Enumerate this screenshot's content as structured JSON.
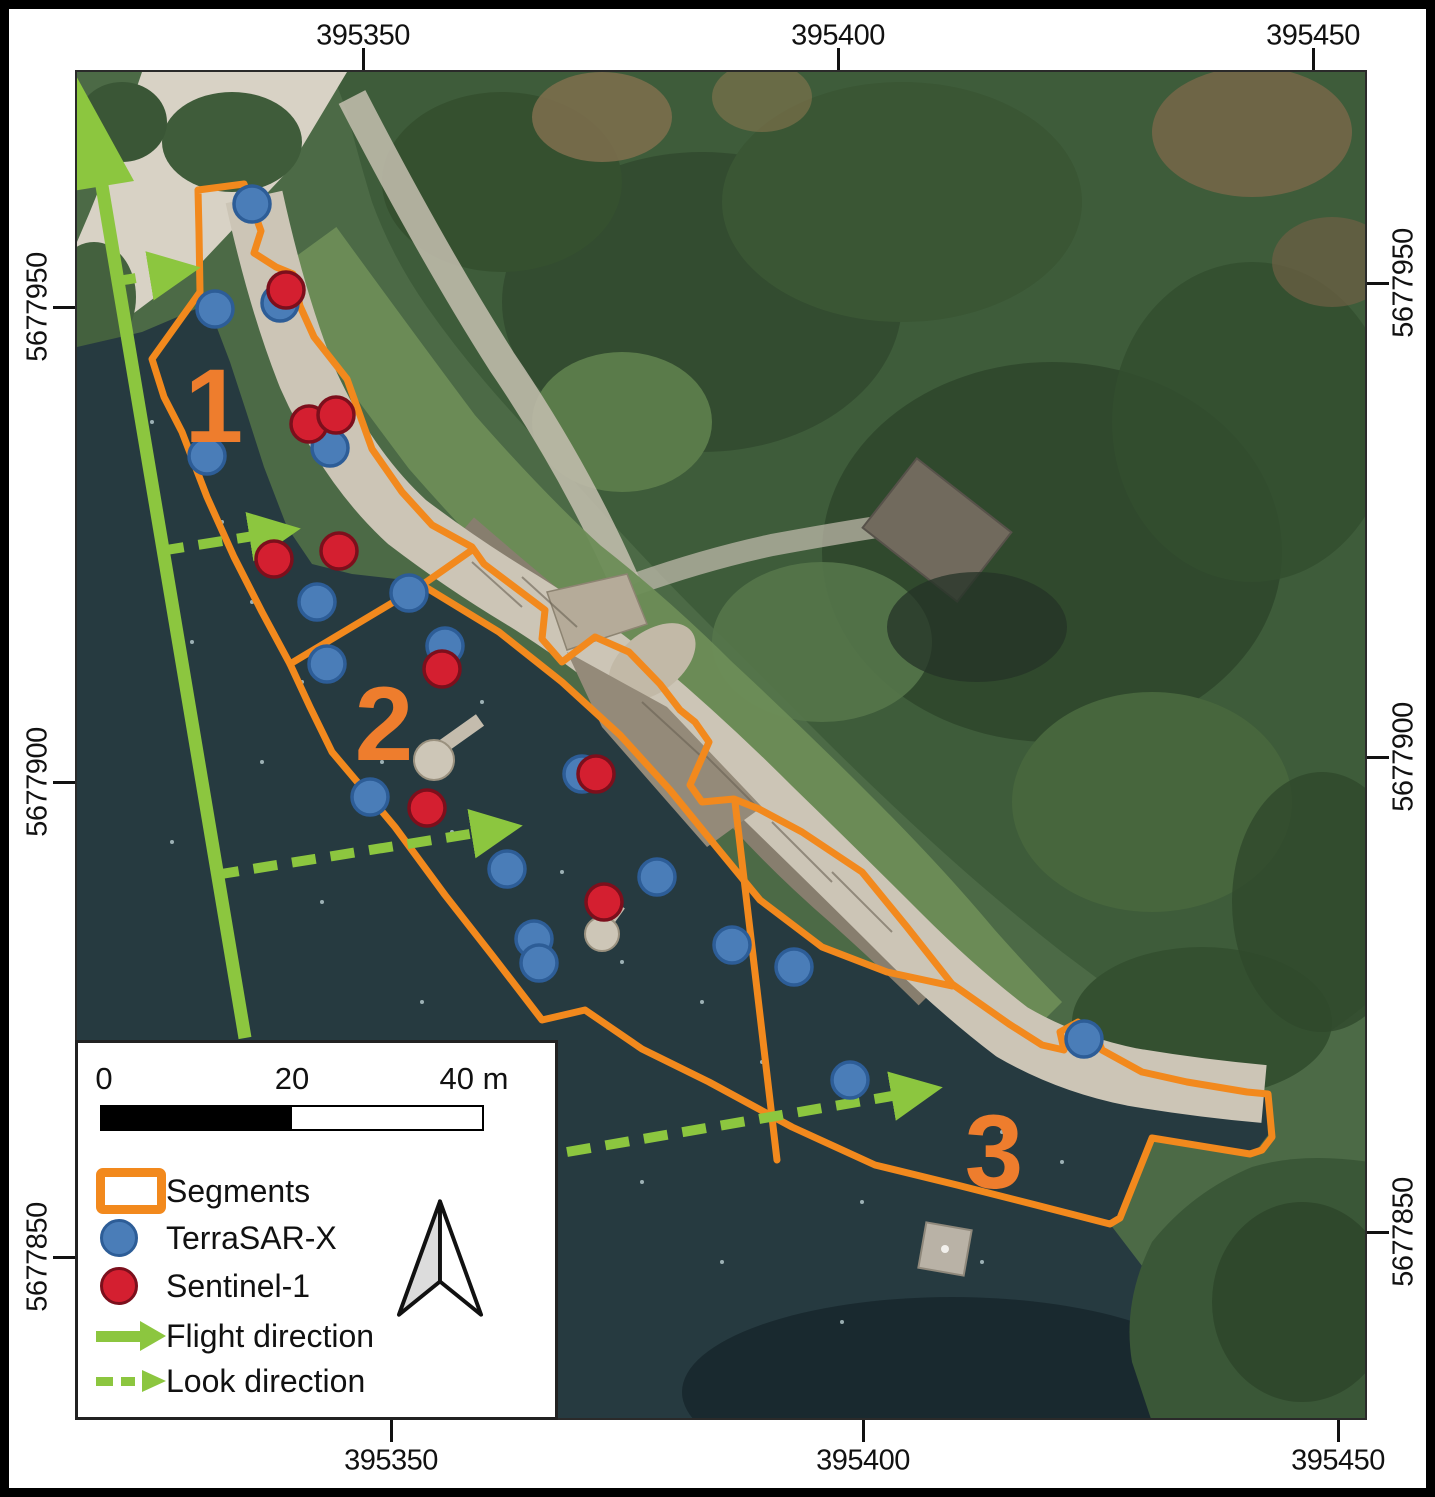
{
  "map": {
    "axis": {
      "top": [
        {
          "text": "395350",
          "x": 363
        },
        {
          "text": "395400",
          "x": 838
        },
        {
          "text": "395450",
          "x": 1313
        }
      ],
      "bottom": [
        {
          "text": "395350",
          "x": 391
        },
        {
          "text": "395400",
          "x": 863
        },
        {
          "text": "395450",
          "x": 1338
        }
      ],
      "left": [
        {
          "text": "5677950",
          "y": 307
        },
        {
          "text": "5677900",
          "y": 782
        },
        {
          "text": "5677850",
          "y": 1257
        }
      ],
      "right": [
        {
          "text": "5677950",
          "y": 283
        },
        {
          "text": "5677900",
          "y": 757
        },
        {
          "text": "5677850",
          "y": 1232
        }
      ]
    },
    "segment_labels": [
      {
        "text": "1",
        "x": 212,
        "y": 403
      },
      {
        "text": "2",
        "x": 382,
        "y": 722
      },
      {
        "text": "3",
        "x": 992,
        "y": 1150
      }
    ],
    "points": {
      "terrasar_x": [
        [
          250,
          202
        ],
        [
          213,
          307
        ],
        [
          278,
          301
        ],
        [
          205,
          454
        ],
        [
          328,
          446
        ],
        [
          315,
          600
        ],
        [
          325,
          662
        ],
        [
          407,
          591
        ],
        [
          443,
          644
        ],
        [
          368,
          795
        ],
        [
          580,
          772
        ],
        [
          505,
          867
        ],
        [
          655,
          875
        ],
        [
          532,
          937
        ],
        [
          537,
          961
        ],
        [
          730,
          943
        ],
        [
          792,
          965
        ],
        [
          848,
          1078
        ],
        [
          1082,
          1037
        ]
      ],
      "sentinel_1": [
        [
          284,
          288
        ],
        [
          307,
          422
        ],
        [
          334,
          413
        ],
        [
          272,
          557
        ],
        [
          337,
          549
        ],
        [
          440,
          667
        ],
        [
          425,
          806
        ],
        [
          594,
          772
        ],
        [
          602,
          900
        ]
      ]
    }
  },
  "legend": {
    "scalebar": {
      "ticks": [
        "0",
        "20",
        "40 m"
      ]
    },
    "items": [
      {
        "label": "Segments"
      },
      {
        "label": "TerraSAR-X"
      },
      {
        "label": "Sentinel-1"
      },
      {
        "label": "Flight direction"
      },
      {
        "label": "Look direction"
      }
    ]
  },
  "colors": {
    "segments_orange": "#f2891d",
    "terrasar_blue": "#4a7db8",
    "sentinel_red": "#d41f30",
    "direction_green": "#8cc63f",
    "water": "#263a40"
  }
}
